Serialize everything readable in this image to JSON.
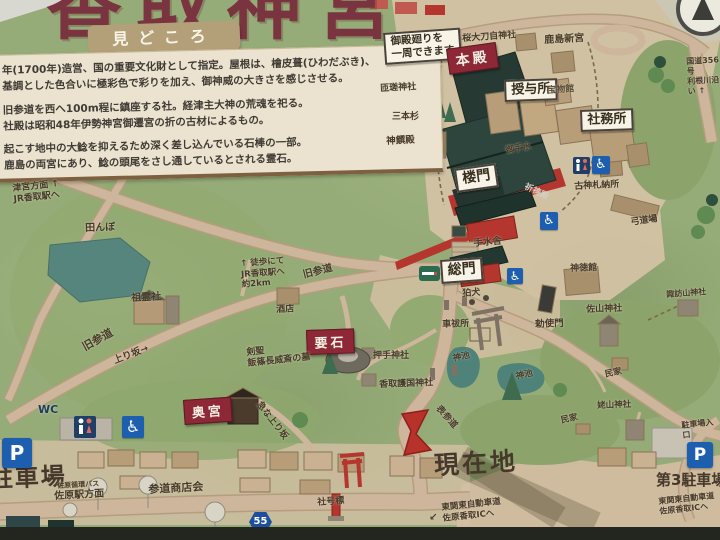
{
  "board": {
    "title_partial": "香取神宮",
    "ribbon": "見どころ"
  },
  "info_panel": {
    "lines": [
      "年(1700年)造営、国の重要文化財として指定。屋根は、檜皮葺(ひわだぶき)、",
      "基調とした色合いに極彩色で彩りを加え、御神威の大きさを感じさせる。",
      "旧参道を西へ100m程に鎮座する社。経津主大神の荒魂を祀る。",
      "社殿は昭和48年伊勢神宮御遷宮の折の古材によるもの。",
      "起こす地中の大鯰を抑えるため深く差し込んでいる石棒の一部。",
      "鹿島の両宮にあり、鯰の頭尾をさし通しているとされる霊石。"
    ]
  },
  "icons": {
    "parking": "P",
    "wc": "WC",
    "route_55": "55",
    "wheelchair_glyph": "♿",
    "compass": "compass-north"
  },
  "colors": {
    "map_green": "#96ac78",
    "road_tan": "#cdb69b",
    "panel_cream": "#ebe2cf",
    "red_label": "#8e2837",
    "shrine_red": "#b5362e",
    "roof_dark": "#2c403a",
    "water_teal": "#55857c",
    "sign_blue": "#1d5fae",
    "title_maroon": "#7a3440"
  },
  "map": {
    "labels": {
      "goten_note": "御殿廻りを\n一周できます",
      "honden": "本殿",
      "sakura_otaji": "桜大刀自神社",
      "kashima_shingu": "鹿島新宮",
      "sosa_jinja": "匝瑳神社",
      "sanbonsugi": "三本杉",
      "shinsenden": "神饌殿",
      "juyosho": "授与所",
      "homotsukan": "宝物館",
      "shamusho": "社務所",
      "romon": "楼門",
      "otemizu": "御手水",
      "kitoden": "祈祷殿",
      "furuofuda_nosho": "古神札納所",
      "kyudojo": "弓道場",
      "temizusha": "手水舎",
      "somon": "総門",
      "shintokukan": "神徳館",
      "komainu": "狛犬",
      "kurumabaraisho": "車祓所",
      "chokushimon": "勅使門",
      "sayama_jinja": "佐山神社",
      "suwayama_jinja": "諏訪山神社",
      "oshide_jinja": "押手神社",
      "gokoku_jinja": "香取護国神社",
      "shinchi_1": "神池",
      "shinchi_2": "神池",
      "minka_1": "民家",
      "minka_2": "民家",
      "ubayama_jinja": "姥山神社",
      "kanameishi": "要石",
      "okunomiya": "奥宮",
      "soreisha": "祖霊社",
      "mise": "酒店",
      "kensei_grave": "剣聖\n飯篠長威斎の墓",
      "tanbo": "田んぼ",
      "tsunomiya_homen": "津宮方面 ↑\nJR香取駅へ",
      "toho_jr": "↑ 徒歩にて\nJR香取駅へ\n約2km",
      "kyusando_1": "旧参道",
      "kyusando_2": "旧参道",
      "noborizaka": "上り坂→",
      "kyuna_noborizaka": "急な上り坂",
      "omotesando": "表参道",
      "genzaichi": "現在地",
      "chushajo": "駐車場",
      "sando_shotenkai": "参道商店会",
      "sawara_junkan_bus": "佐原循環バス",
      "sawaraeki_homen": "佐原駅方面",
      "shagohyo": "社号標",
      "ic_arrow": "↙",
      "higashi_kanto_1": "東関東自動車道\n佐原香取ICへ",
      "higashi_kanto_2": "東関東自動車道\n佐原香取ICへ",
      "dai3_chushajo": "第3駐車場",
      "chushajo_iriguchi": "駐車場入口",
      "kokudo_356": "国道356号\n利根川沿い ↑"
    }
  }
}
